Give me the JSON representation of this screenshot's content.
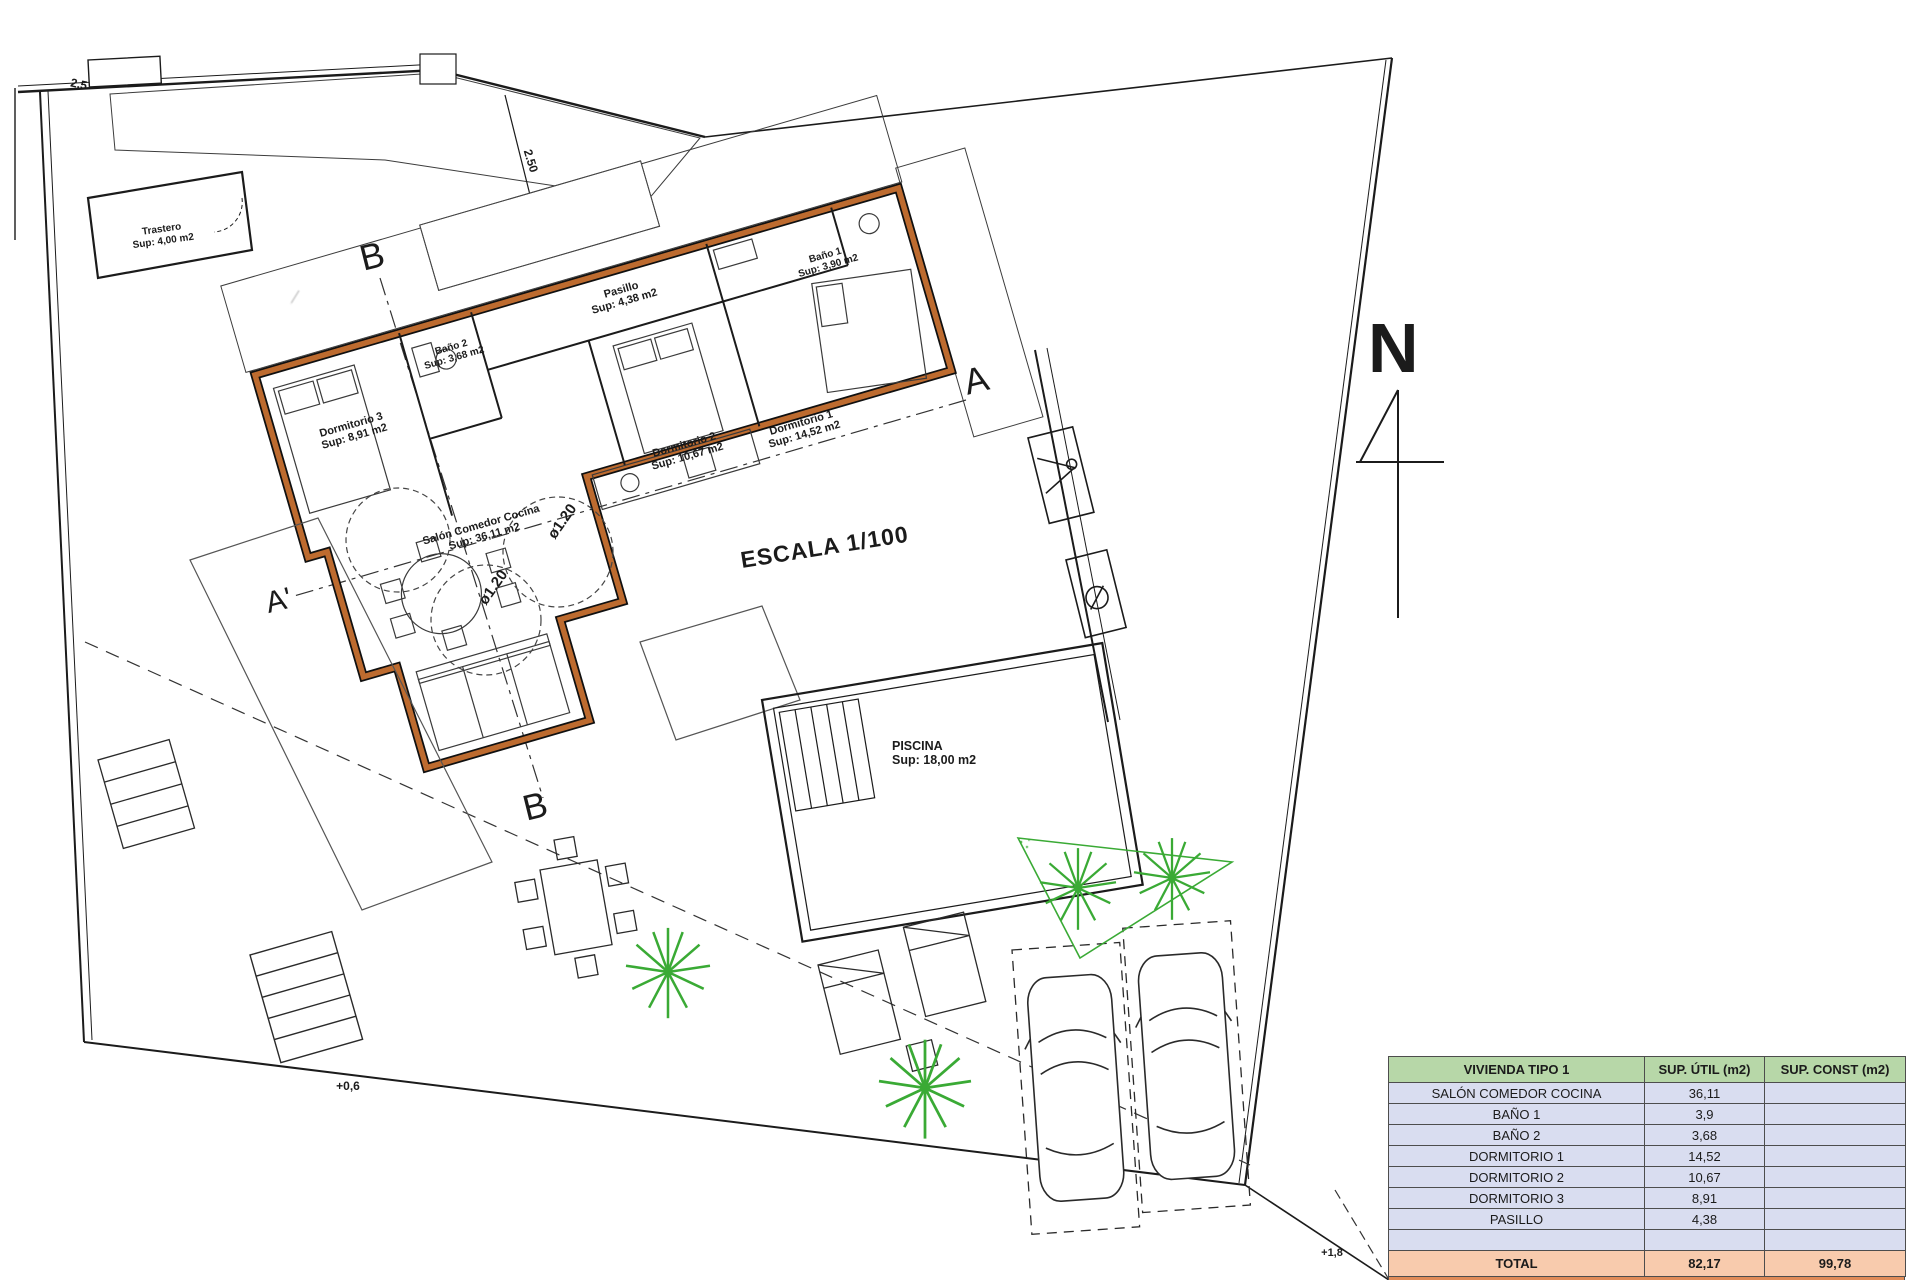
{
  "colors": {
    "line": "#1b1b1b",
    "wall_orange": "#bd6b2f",
    "vegetation_green": "#3aaa35",
    "table_header_bg": "#b7d7a8",
    "table_row_bg": "#d9ddf0",
    "table_total_bg": "#f8cbad",
    "table_strip_bg": "#e08b57"
  },
  "plan": {
    "labels": [
      {
        "line1": "Trastero",
        "line2": "Sup: 4,00 m2"
      },
      {
        "line1": "Pasillo",
        "line2": "Sup: 4,38 m2"
      },
      {
        "line1": "Baño 1",
        "line2": "Sup: 3,90 m2"
      },
      {
        "line1": "Baño 2",
        "line2": "Sup: 3,68 m2"
      },
      {
        "line1": "Dormitorio 1",
        "line2": "Sup: 14,52 m2"
      },
      {
        "line1": "Dormitorio 2",
        "line2": "Sup: 10,67 m2"
      },
      {
        "line1": "Dormitorio 3",
        "line2": "Sup: 8,91 m2"
      },
      {
        "line1": "Salón Comedor Cocina",
        "line2": "Sup: 36,11 m2"
      },
      {
        "line1": "PISCINA",
        "line2": "Sup: 18,00 m2"
      }
    ],
    "annotations": {
      "escala": "ESCALA 1/100",
      "north": "N",
      "section_b_top": "B",
      "section_b_bottom": "B",
      "section_a": "A",
      "section_a_prime": "A'",
      "dim_250": "2.50",
      "dim_25": "2.5",
      "level_plus06": "+0,6",
      "level_plus18": "+1,8",
      "turning_circle_1": "ø1.20",
      "turning_circle_2": "ø1.20"
    }
  },
  "table": {
    "header": [
      "VIVIENDA TIPO 1",
      "SUP. ÚTIL (m2)",
      "SUP. CONST (m2)"
    ],
    "rows": [
      {
        "name": "SALÓN COMEDOR COCINA",
        "util": "36,11",
        "const": ""
      },
      {
        "name": "BAÑO 1",
        "util": "3,9",
        "const": ""
      },
      {
        "name": "BAÑO 2",
        "util": "3,68",
        "const": ""
      },
      {
        "name": "DORMITORIO 1",
        "util": "14,52",
        "const": ""
      },
      {
        "name": "DORMITORIO 2",
        "util": "10,67",
        "const": ""
      },
      {
        "name": "DORMITORIO 3",
        "util": "8,91",
        "const": ""
      },
      {
        "name": "PASILLO",
        "util": "4,38",
        "const": ""
      },
      {
        "name": "",
        "util": "",
        "const": ""
      }
    ],
    "total": {
      "name": "TOTAL",
      "util": "82,17",
      "const": "99,78"
    }
  }
}
